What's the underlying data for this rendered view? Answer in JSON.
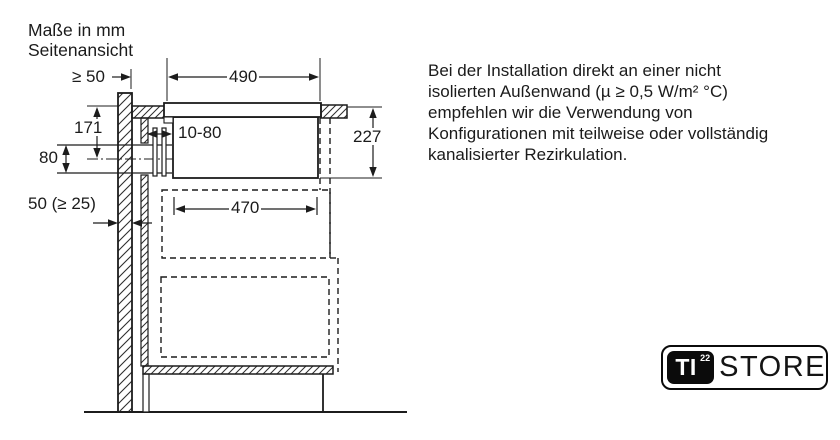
{
  "title": {
    "line1": "Maße in mm",
    "line2": "Seitenansicht"
  },
  "dimensions": {
    "wall_distance": "≥ 50",
    "hob_width": "490",
    "worktop_to_duct_center": "171",
    "duct_opening_height": "80",
    "wall_thickness": "50 (≥ 25)",
    "rear_gap": "10-80",
    "unit_height": "227",
    "unit_lower_width": "470"
  },
  "note": {
    "lines": [
      "Bei der Installation direkt an einer nicht",
      "isolierten Außenwand (µ ≥ 0,5 W/m² °C)",
      "empfehlen wir die Verwendung von",
      "Konfigurationen mit teilweise oder vollständig",
      "kanalisierter Rezirkulation."
    ]
  },
  "logo": {
    "prefix": "TI",
    "superscript": "22",
    "name": "STORE"
  },
  "colors": {
    "line": "#1c1c1c",
    "background": "#ffffff",
    "logo_black": "#0b0b0b"
  }
}
